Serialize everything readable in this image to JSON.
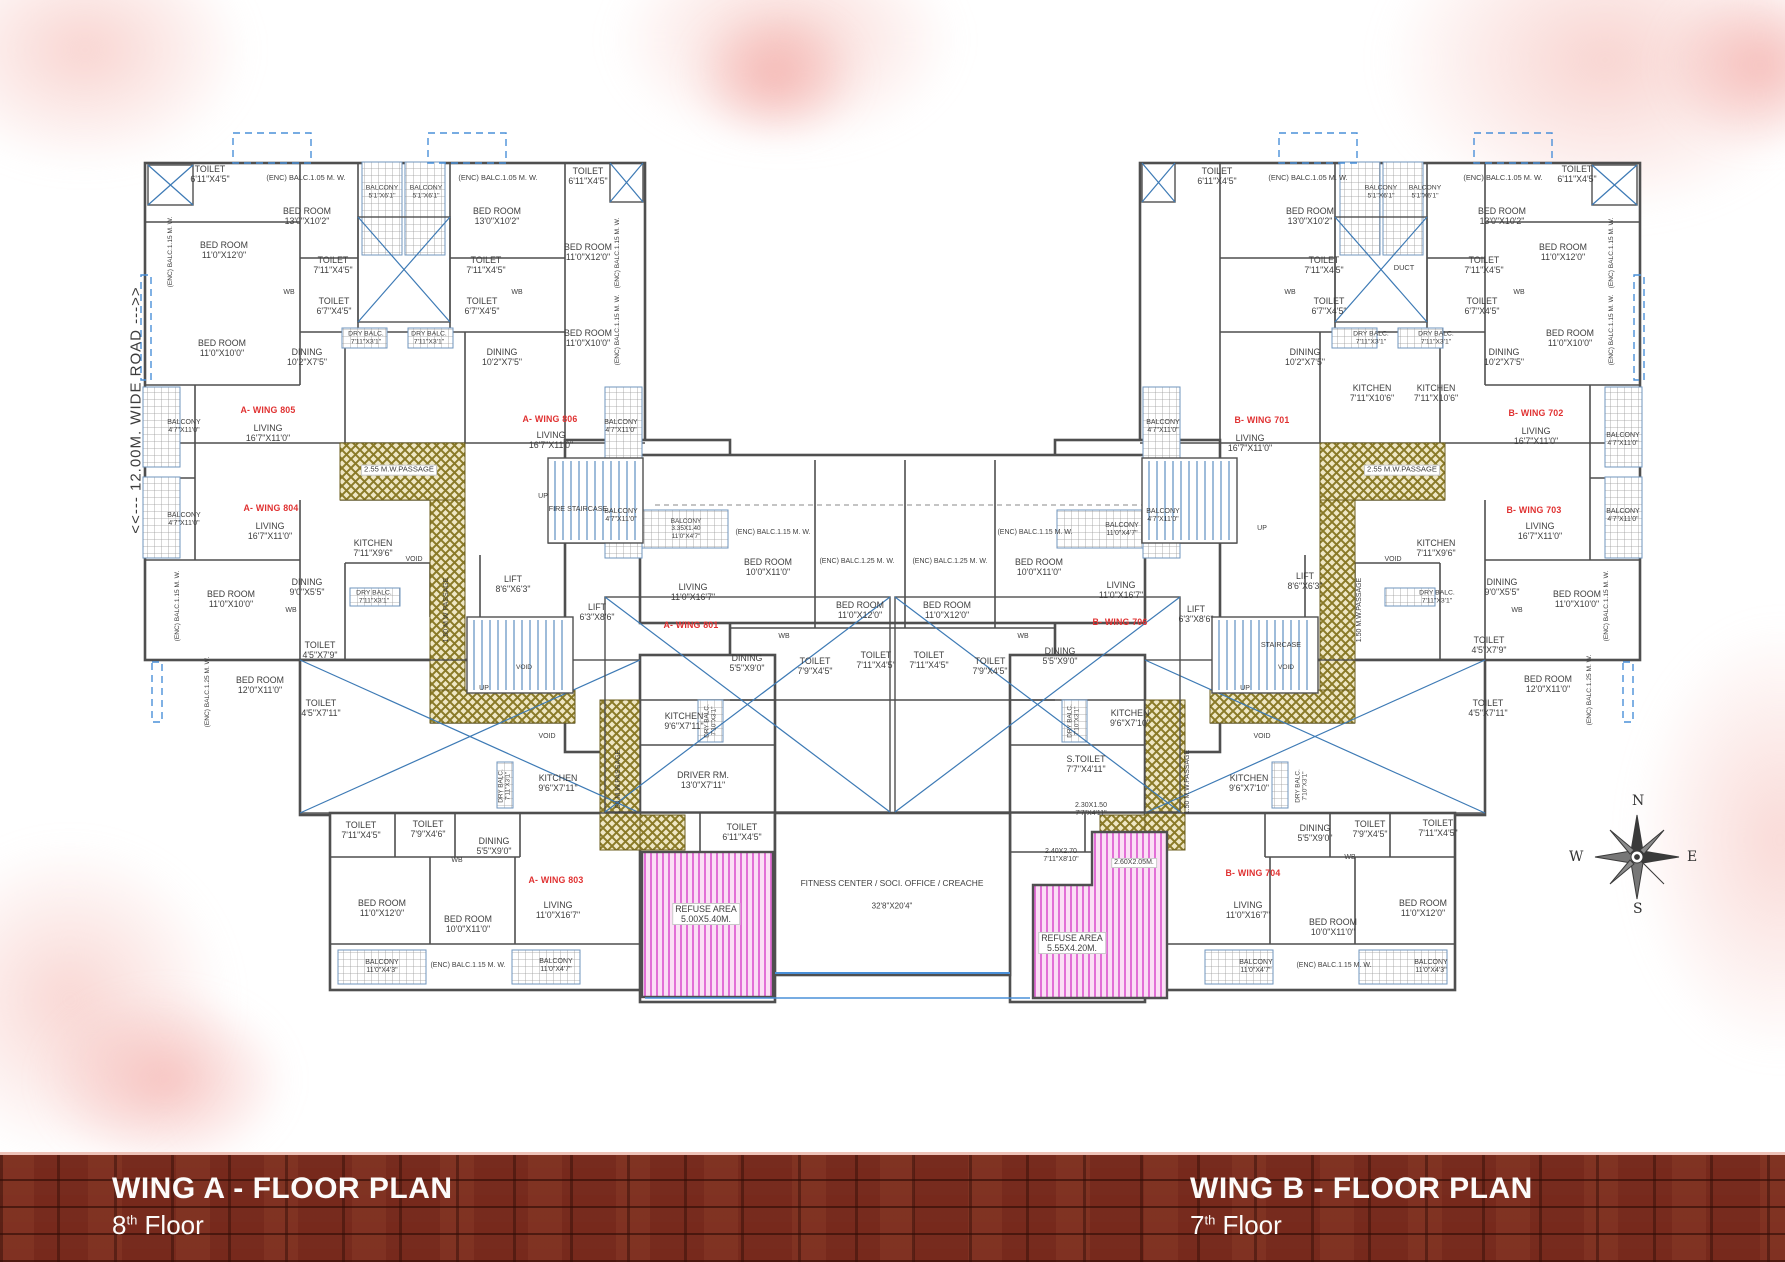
{
  "road_label": "<<--- 12.00M. WIDE ROAD --->>",
  "compass": {
    "n": "N",
    "e": "E",
    "s": "S",
    "w": "W"
  },
  "footer": {
    "wing_a": {
      "title": "WING A - FLOOR PLAN",
      "floor_number": "8",
      "floor_suffix": "th",
      "floor_word": "Floor"
    },
    "wing_b": {
      "title": "WING B - FLOOR PLAN",
      "floor_number": "7",
      "floor_suffix": "th",
      "floor_word": "Floor"
    }
  },
  "colors": {
    "wall": "#4f4f4f",
    "blue": "#3d7ab5",
    "unit_red": "#e03131",
    "passage_gold": "#8a7a28",
    "passage_bg": "#efe7c4",
    "refuse_pink": "#e26fd6",
    "refuse_bg": "#fbdff5",
    "brick": "#77291c"
  },
  "plan": {
    "labels": [
      {
        "t": "TOILET\n6'11\"X4'5\"",
        "x": 210,
        "y": 174
      },
      {
        "t": "(ENC) BALC.1.15 M. W.",
        "x": 171,
        "y": 252,
        "r": 1,
        "s": 6.6
      },
      {
        "t": "BED ROOM\n11'0\"X12'0\"",
        "x": 224,
        "y": 250
      },
      {
        "t": "BED ROOM\n11'0\"X10'0\"",
        "x": 222,
        "y": 348
      },
      {
        "t": "BALCONY\n4'7\"X11'0\"",
        "x": 184,
        "y": 427,
        "s": 7
      },
      {
        "t": "BALCONY\n4'7\"X11'0\"",
        "x": 184,
        "y": 520,
        "s": 7
      },
      {
        "t": "(ENC) BALC.1.15 M. W.",
        "x": 178,
        "y": 606,
        "r": 1,
        "s": 6.6
      },
      {
        "t": "(ENC) BALC.1.25 M. W.",
        "x": 208,
        "y": 692,
        "r": 1,
        "s": 6.6
      },
      {
        "t": "(ENC) BALC.1.05 M. W.",
        "x": 306,
        "y": 178,
        "s": 7.4
      },
      {
        "t": "BED ROOM\n13'0\"X10'2\"",
        "x": 307,
        "y": 216
      },
      {
        "t": "BALCONY\n5'1\"X6'1\"",
        "x": 382,
        "y": 192,
        "s": 6.8
      },
      {
        "t": "BALCONY\n5'1\"X6'1\"",
        "x": 426,
        "y": 192,
        "s": 6.8
      },
      {
        "t": "(ENC) BALC.1.05 M. W.",
        "x": 498,
        "y": 178,
        "s": 7.4
      },
      {
        "t": "BED ROOM\n13'0\"X10'2\"",
        "x": 497,
        "y": 216
      },
      {
        "t": "TOILET\n6'11\"X4'5\"",
        "x": 588,
        "y": 176
      },
      {
        "t": "TOILET\n7'11\"X4'5\"",
        "x": 333,
        "y": 265
      },
      {
        "t": "TOILET\n7'11\"X4'5\"",
        "x": 486,
        "y": 265
      },
      {
        "t": "WB",
        "x": 289,
        "y": 293,
        "s": 7
      },
      {
        "t": "WB",
        "x": 517,
        "y": 293,
        "s": 7
      },
      {
        "t": "TOILET\n6'7\"X4'5\"",
        "x": 334,
        "y": 306
      },
      {
        "t": "TOILET\n6'7\"X4'5\"",
        "x": 482,
        "y": 306
      },
      {
        "t": "BED ROOM\n11'0\"X12'0\"",
        "x": 588,
        "y": 252
      },
      {
        "t": "(ENC) BALC.1.15 M. W.",
        "x": 618,
        "y": 253,
        "r": 1,
        "s": 6.6
      },
      {
        "t": "(ENC) BALC.1.15 M. W.",
        "x": 618,
        "y": 330,
        "r": 1,
        "s": 6.6
      },
      {
        "t": "DRY BALC.\n7'11\"X3'1\"",
        "x": 366,
        "y": 338,
        "s": 6.8
      },
      {
        "t": "DRY BALC.\n7'11\"X3'1\"",
        "x": 429,
        "y": 338,
        "s": 6.8
      },
      {
        "t": "DINING\n10'2\"X7'5\"",
        "x": 307,
        "y": 357
      },
      {
        "t": "DINING\n10'2\"X7'5\"",
        "x": 502,
        "y": 357
      },
      {
        "t": "BED ROOM\n11'0\"X10'0\"",
        "x": 588,
        "y": 338
      },
      {
        "t": "A- WING 805",
        "x": 268,
        "y": 410,
        "c": "red"
      },
      {
        "t": "LIVING\n16'7\"X11'0\"",
        "x": 268,
        "y": 433
      },
      {
        "t": "A- WING 806",
        "x": 550,
        "y": 419,
        "c": "red"
      },
      {
        "t": "LIVING\n16'7\"X11'0\"",
        "x": 551,
        "y": 440
      },
      {
        "t": "2.55 M.W.PASSAGE",
        "x": 399,
        "y": 470,
        "s": 7.6,
        "bg": 1
      },
      {
        "t": "A- WING 804",
        "x": 271,
        "y": 508,
        "c": "red"
      },
      {
        "t": "LIVING\n16'7\"X11'0\"",
        "x": 270,
        "y": 531
      },
      {
        "t": "BALCONY\n4'7\"X11'0\"",
        "x": 621,
        "y": 427,
        "s": 7
      },
      {
        "t": "BALCONY\n4'7\"X11'0\"",
        "x": 621,
        "y": 516,
        "s": 7
      },
      {
        "t": "UP",
        "x": 543,
        "y": 497,
        "s": 7
      },
      {
        "t": "FIRE STAIRCASE",
        "x": 578,
        "y": 509,
        "s": 7.2
      },
      {
        "t": "KITCHEN\n7'11\"X9'6\"",
        "x": 373,
        "y": 548
      },
      {
        "t": "VOID",
        "x": 414,
        "y": 560,
        "s": 7
      },
      {
        "t": "LIFT\n8'6\"X6'3\"",
        "x": 513,
        "y": 584
      },
      {
        "t": "LIFT\n6'3\"X8'6\"",
        "x": 597,
        "y": 612
      },
      {
        "t": "1.50 M.W PASSAGE",
        "x": 447,
        "y": 610,
        "r": 1,
        "s": 7
      },
      {
        "t": "VOID",
        "x": 524,
        "y": 668,
        "s": 6.6
      },
      {
        "t": "UP",
        "x": 484,
        "y": 689,
        "s": 7
      },
      {
        "t": "DINING\n9'0\"X5'5\"",
        "x": 307,
        "y": 587
      },
      {
        "t": "WB",
        "x": 291,
        "y": 611,
        "s": 7
      },
      {
        "t": "BED ROOM\n11'0\"X10'0\"",
        "x": 231,
        "y": 599
      },
      {
        "t": "DRY BALC.\n7'11\"X3'1\"",
        "x": 374,
        "y": 597,
        "s": 6.8
      },
      {
        "t": "TOILET\n4'5\"X7'9\"",
        "x": 320,
        "y": 650
      },
      {
        "t": "BED ROOM\n12'0\"X11'0\"",
        "x": 260,
        "y": 685
      },
      {
        "t": "TOILET\n4'5\"X7'11\"",
        "x": 321,
        "y": 708
      },
      {
        "t": "KITCHEN\n9'6\"X7'11\"",
        "x": 558,
        "y": 783
      },
      {
        "t": "DRY BALC.\n7'11\"X3'1\"",
        "x": 505,
        "y": 786,
        "r": 1,
        "s": 6.4
      },
      {
        "t": "VOID",
        "x": 547,
        "y": 737,
        "s": 7
      },
      {
        "t": "1.50 M.W.PASSAGE",
        "x": 619,
        "y": 782,
        "r": 1,
        "s": 7
      },
      {
        "t": "KITCHEN\n9'6\"X7'11\"",
        "x": 684,
        "y": 721
      },
      {
        "t": "DRIVER RM.\n13'0\"X7'11\"",
        "x": 703,
        "y": 780
      },
      {
        "t": "TOILET\n6'11\"X4'5\"",
        "x": 742,
        "y": 832
      },
      {
        "t": "REFUSE AREA\n5.00X5.40M.",
        "x": 706,
        "y": 914,
        "bg": 1
      },
      {
        "t": "TOILET\n7'11\"X4'5\"",
        "x": 361,
        "y": 830
      },
      {
        "t": "TOILET\n7'9\"X4'6\"",
        "x": 428,
        "y": 829
      },
      {
        "t": "DINING\n5'5\"X9'0\"",
        "x": 494,
        "y": 846
      },
      {
        "t": "WB",
        "x": 457,
        "y": 861,
        "s": 7
      },
      {
        "t": "A- WING 803",
        "x": 556,
        "y": 880,
        "c": "red"
      },
      {
        "t": "LIVING\n11'0\"X16'7\"",
        "x": 558,
        "y": 910
      },
      {
        "t": "BED ROOM\n11'0\"X12'0\"",
        "x": 382,
        "y": 908
      },
      {
        "t": "BED ROOM\n10'0\"X11'0\"",
        "x": 468,
        "y": 924
      },
      {
        "t": "BALCONY\n11'0\"X4'3\"",
        "x": 382,
        "y": 967,
        "s": 7
      },
      {
        "t": "(ENC) BALC.1.15 M. W.",
        "x": 468,
        "y": 966,
        "s": 7
      },
      {
        "t": "BALCONY\n11'0\"X4'7\"",
        "x": 556,
        "y": 966,
        "s": 7
      },
      {
        "t": "BALCONY\n3.35X1.40\n11'0\"X4'7\"",
        "x": 686,
        "y": 529,
        "s": 6.4
      },
      {
        "t": "(ENC) BALC.1.15 M. W.",
        "x": 773,
        "y": 533,
        "s": 7
      },
      {
        "t": "BED ROOM\n10'0\"X11'0\"",
        "x": 768,
        "y": 567
      },
      {
        "t": "LIVING\n11'0\"X16'7\"",
        "x": 693,
        "y": 592
      },
      {
        "t": "A- WING 801",
        "x": 691,
        "y": 625,
        "c": "red"
      },
      {
        "t": "DINING\n5'5\"X9'0\"",
        "x": 747,
        "y": 663
      },
      {
        "t": "WB",
        "x": 784,
        "y": 637,
        "s": 7
      },
      {
        "t": "TOILET\n7'9\"X4'5\"",
        "x": 815,
        "y": 666
      },
      {
        "t": "(ENC) BALC.1.25 M. W.",
        "x": 857,
        "y": 562,
        "s": 7
      },
      {
        "t": "BED ROOM\n11'0\"X12'0\"",
        "x": 860,
        "y": 610
      },
      {
        "t": "TOILET\n7'11\"X4'5\"",
        "x": 876,
        "y": 660
      },
      {
        "t": "(ENC) BALC.1.25 M. W.",
        "x": 950,
        "y": 562,
        "s": 7
      },
      {
        "t": "BED ROOM\n11'0\"X12'0\"",
        "x": 947,
        "y": 610
      },
      {
        "t": "TOILET\n7'11\"X4'5\"",
        "x": 929,
        "y": 660
      },
      {
        "t": "TOILET\n7'9\"X4'5\"",
        "x": 990,
        "y": 666
      },
      {
        "t": "WB",
        "x": 1023,
        "y": 637,
        "s": 7
      },
      {
        "t": "(ENC) BALC.1.15 M. W.",
        "x": 1035,
        "y": 533,
        "s": 7
      },
      {
        "t": "BED ROOM\n10'0\"X11'0\"",
        "x": 1039,
        "y": 567
      },
      {
        "t": "BALCONY\n11'0\"X4'7\"",
        "x": 1122,
        "y": 530,
        "s": 7
      },
      {
        "t": "LIVING\n11'0\"X16'7\"",
        "x": 1121,
        "y": 590
      },
      {
        "t": "B- WING 706",
        "x": 1120,
        "y": 622,
        "c": "red"
      },
      {
        "t": "DINING\n5'5\"X9'0\"",
        "x": 1060,
        "y": 656
      },
      {
        "t": "KITCHEN\n9'6\"X7'10\"",
        "x": 1130,
        "y": 718
      },
      {
        "t": "DRY BALC.\n7'10\"X3'1\"",
        "x": 711,
        "y": 721,
        "r": 1,
        "s": 6.4
      },
      {
        "t": "DRY BALC.\n7'10\"X3'1\"",
        "x": 1074,
        "y": 721,
        "r": 1,
        "s": 6.4
      },
      {
        "t": "LIFT\n6'3\"X8'6\"",
        "x": 1196,
        "y": 614
      },
      {
        "t": "S.TOILET\n7'7\"X4'11\"",
        "x": 1086,
        "y": 764
      },
      {
        "t": "2.30X1.50\n7'7\"X4'11\"",
        "x": 1091,
        "y": 810,
        "s": 7
      },
      {
        "t": "2.40X2.70\n7'11\"X8'10\"",
        "x": 1061,
        "y": 856,
        "s": 7
      },
      {
        "t": "2.60X2.05M.",
        "x": 1134,
        "y": 863,
        "s": 7,
        "bg": 1
      },
      {
        "t": "REFUSE AREA\n5.55X4.20M.",
        "x": 1072,
        "y": 943,
        "bg": 1
      },
      {
        "t": "FITNESS CENTER / SOCI. OFFICE / CREACHE",
        "x": 892,
        "y": 884,
        "s": 8.4
      },
      {
        "t": "32'8\"X20'4\"",
        "x": 892,
        "y": 906,
        "s": 8
      },
      {
        "t": "TOILET\n6'11\"X4'5\"",
        "x": 1217,
        "y": 176
      },
      {
        "t": "(ENC) BALC.1.05 M. W.",
        "x": 1308,
        "y": 178,
        "s": 7.4
      },
      {
        "t": "BED ROOM\n13'0\"X10'2\"",
        "x": 1310,
        "y": 216
      },
      {
        "t": "BALCONY\n5'1\"X6'1\"",
        "x": 1381,
        "y": 192,
        "s": 6.8
      },
      {
        "t": "BALCONY\n5'1\"X6'1\"",
        "x": 1425,
        "y": 192,
        "s": 6.8
      },
      {
        "t": "(ENC) BALC.1.05 M. W.",
        "x": 1503,
        "y": 178,
        "s": 7.4
      },
      {
        "t": "BED ROOM\n13'0\"X10'2\"",
        "x": 1502,
        "y": 216
      },
      {
        "t": "TOILET\n6'11\"X4'5\"",
        "x": 1577,
        "y": 174
      },
      {
        "t": "BED ROOM\n11'0\"X12'0\"",
        "x": 1563,
        "y": 252
      },
      {
        "t": "BED ROOM\n11'0\"X10'0\"",
        "x": 1570,
        "y": 338
      },
      {
        "t": "(ENC) BALC.1.15 M. W.",
        "x": 1612,
        "y": 253,
        "r": 1,
        "s": 6.6
      },
      {
        "t": "(ENC) BALC.1.15 M. W.",
        "x": 1612,
        "y": 330,
        "r": 1,
        "s": 6.6
      },
      {
        "t": "TOILET\n7'11\"X4'5\"",
        "x": 1324,
        "y": 265
      },
      {
        "t": "TOILET\n7'11\"X4'5\"",
        "x": 1484,
        "y": 265
      },
      {
        "t": "WB",
        "x": 1290,
        "y": 293,
        "s": 7
      },
      {
        "t": "WB",
        "x": 1519,
        "y": 293,
        "s": 7
      },
      {
        "t": "TOILET\n6'7\"X4'5\"",
        "x": 1329,
        "y": 306
      },
      {
        "t": "TOILET\n6'7\"X4'5\"",
        "x": 1482,
        "y": 306
      },
      {
        "t": "DUCT",
        "x": 1404,
        "y": 268,
        "s": 7.4
      },
      {
        "t": "DRY BALC.\n7'11\"X3'1\"",
        "x": 1371,
        "y": 338,
        "s": 6.8
      },
      {
        "t": "DRY BALC.\n7'11\"X3'1\"",
        "x": 1436,
        "y": 338,
        "s": 6.8
      },
      {
        "t": "DINING\n10'2\"X7'5\"",
        "x": 1305,
        "y": 357
      },
      {
        "t": "DINING\n10'2\"X7'5\"",
        "x": 1504,
        "y": 357
      },
      {
        "t": "B- WING 701",
        "x": 1262,
        "y": 420,
        "c": "red"
      },
      {
        "t": "LIVING\n16'7\"X11'0\"",
        "x": 1250,
        "y": 443
      },
      {
        "t": "KITCHEN\n7'11\"X10'6\"",
        "x": 1372,
        "y": 393
      },
      {
        "t": "KITCHEN\n7'11\"X10'6\"",
        "x": 1436,
        "y": 393
      },
      {
        "t": "B- WING 702",
        "x": 1536,
        "y": 413,
        "c": "red"
      },
      {
        "t": "LIVING\n16'7\"X11'0\"",
        "x": 1536,
        "y": 436
      },
      {
        "t": "2.55 M.W.PASSAGE",
        "x": 1402,
        "y": 470,
        "s": 7.6,
        "bg": 1
      },
      {
        "t": "B- WING 703",
        "x": 1534,
        "y": 510,
        "c": "red"
      },
      {
        "t": "LIVING\n16'7\"X11'0\"",
        "x": 1540,
        "y": 531
      },
      {
        "t": "KITCHEN\n7'11\"X9'6\"",
        "x": 1436,
        "y": 548
      },
      {
        "t": "VOID",
        "x": 1393,
        "y": 560,
        "s": 7
      },
      {
        "t": "UP",
        "x": 1262,
        "y": 529,
        "s": 7
      },
      {
        "t": "BALCONY\n4'7\"X11'0\"",
        "x": 1623,
        "y": 440,
        "s": 7
      },
      {
        "t": "BALCONY\n4'7\"X11'0\"",
        "x": 1623,
        "y": 516,
        "s": 7
      },
      {
        "t": "BALCONY\n4'7\"X11'0\"",
        "x": 1163,
        "y": 427,
        "s": 7
      },
      {
        "t": "BALCONY\n4'7\"X11'0\"",
        "x": 1163,
        "y": 516,
        "s": 7
      },
      {
        "t": "LIFT\n8'6\"X6'3\"",
        "x": 1305,
        "y": 581
      },
      {
        "t": "STAIRCASE",
        "x": 1281,
        "y": 645,
        "s": 7.2
      },
      {
        "t": "VOID",
        "x": 1286,
        "y": 668,
        "s": 6.6
      },
      {
        "t": "UP",
        "x": 1245,
        "y": 689,
        "s": 7
      },
      {
        "t": "1.50 M.W.PASSAGE",
        "x": 1360,
        "y": 610,
        "r": 1,
        "s": 7
      },
      {
        "t": "1.50 M.W.PASSAGE",
        "x": 1188,
        "y": 782,
        "r": 1,
        "s": 7
      },
      {
        "t": "DINING\n9'0\"X5'5\"",
        "x": 1502,
        "y": 587
      },
      {
        "t": "WB",
        "x": 1517,
        "y": 611,
        "s": 7
      },
      {
        "t": "BED ROOM\n11'0\"X10'0\"",
        "x": 1577,
        "y": 599
      },
      {
        "t": "DRY BALC.\n7'11\"X3'1\"",
        "x": 1437,
        "y": 597,
        "s": 6.8
      },
      {
        "t": "TOILET\n4'5\"X7'9\"",
        "x": 1489,
        "y": 645
      },
      {
        "t": "BED ROOM\n12'0\"X11'0\"",
        "x": 1548,
        "y": 684
      },
      {
        "t": "TOILET\n4'5\"X7'11\"",
        "x": 1488,
        "y": 708
      },
      {
        "t": "(ENC) BALC.1.25 M. W.",
        "x": 1590,
        "y": 690,
        "r": 1,
        "s": 6.6
      },
      {
        "t": "(ENC) BALC.1.15 M. W.",
        "x": 1607,
        "y": 606,
        "r": 1,
        "s": 6.6
      },
      {
        "t": "KITCHEN\n9'6\"X7'10\"",
        "x": 1249,
        "y": 783
      },
      {
        "t": "DRY BALC.\n7'10\"X3'1\"",
        "x": 1302,
        "y": 786,
        "r": 1,
        "s": 6.4
      },
      {
        "t": "VOID",
        "x": 1262,
        "y": 737,
        "s": 7
      },
      {
        "t": "B- WING 704",
        "x": 1253,
        "y": 873,
        "c": "red"
      },
      {
        "t": "LIVING\n11'0\"X16'7\"",
        "x": 1248,
        "y": 910
      },
      {
        "t": "TOILET\n7'9\"X4'5\"",
        "x": 1370,
        "y": 829
      },
      {
        "t": "TOILET\n7'11\"X4'5\"",
        "x": 1438,
        "y": 828
      },
      {
        "t": "WB",
        "x": 1350,
        "y": 858,
        "s": 7
      },
      {
        "t": "DINING\n5'5\"X9'0\"",
        "x": 1315,
        "y": 833
      },
      {
        "t": "BED ROOM\n10'0\"X11'0\"",
        "x": 1333,
        "y": 927
      },
      {
        "t": "BED ROOM\n11'0\"X12'0\"",
        "x": 1423,
        "y": 908
      },
      {
        "t": "BALCONY\n11'0\"X4'7\"",
        "x": 1256,
        "y": 967,
        "s": 7
      },
      {
        "t": "(ENC) BALC.1.15 M. W.",
        "x": 1334,
        "y": 966,
        "s": 7
      },
      {
        "t": "BALCONY\n11'0\"X4'3\"",
        "x": 1431,
        "y": 967,
        "s": 7
      }
    ]
  }
}
